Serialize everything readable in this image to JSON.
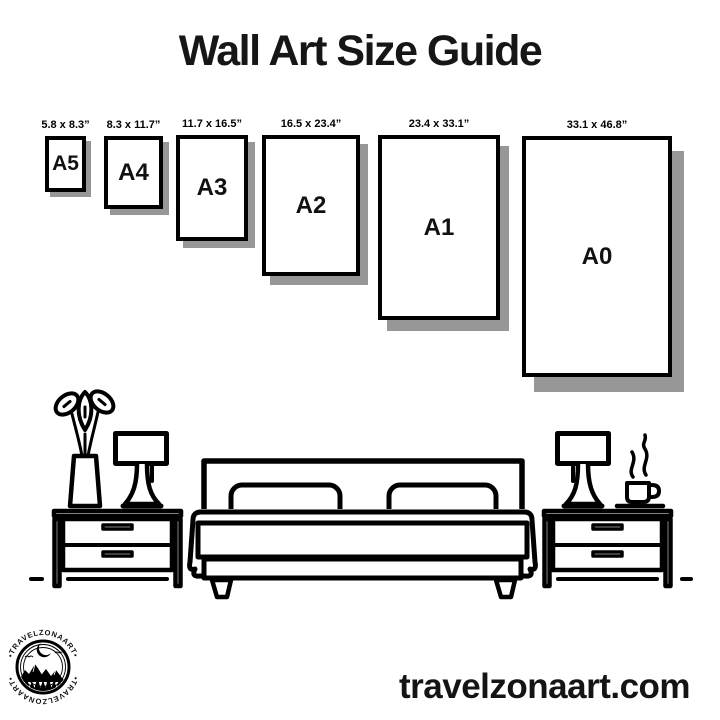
{
  "title": "Wall Art Size Guide",
  "sizes": [
    {
      "name": "A5",
      "dimensions": "5.8 x 8.3”"
    },
    {
      "name": "A4",
      "dimensions": "8.3 x 11.7”"
    },
    {
      "name": "A3",
      "dimensions": "11.7 x 16.5”"
    },
    {
      "name": "A2",
      "dimensions": "16.5 x 23.4”"
    },
    {
      "name": "A1",
      "dimensions": "23.4 x 33.1”"
    },
    {
      "name": "A0",
      "dimensions": "33.1 x 46.8”"
    }
  ],
  "brand": {
    "badge_text_top": "•TRAVELZONAART•",
    "badge_text_bottom": "•TRAVELZONAART•",
    "website": "travelzonaart.com"
  },
  "illustration": {
    "scene": "bedroom line drawing",
    "elements": [
      "flower-vase",
      "table-lamp-left",
      "nightstand-left",
      "double-bed",
      "nightstand-right",
      "table-lamp-right",
      "coffee-cup-with-steam"
    ]
  },
  "colors": {
    "background": "#ffffff",
    "line": "#000000",
    "text": "#161616",
    "frame_shadow": "#979797"
  }
}
